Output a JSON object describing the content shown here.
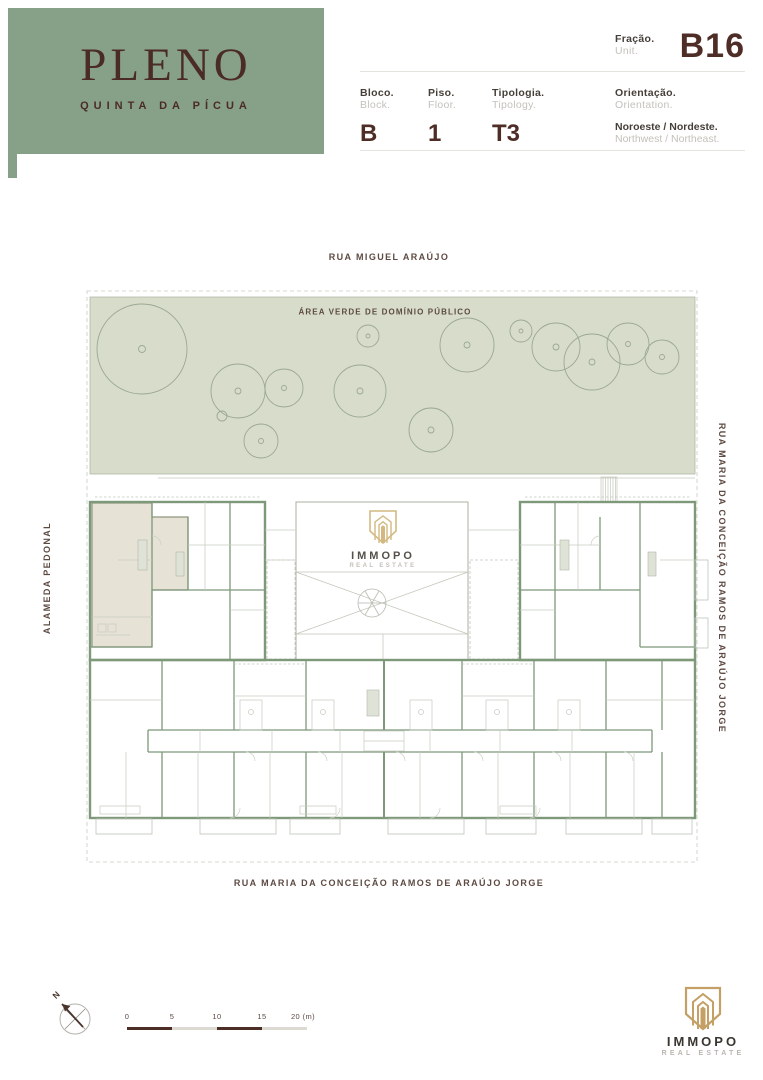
{
  "brand": {
    "name": "PLENO",
    "subtitle": "QUINTA DA PÍCUA",
    "bg_color": "#87a188",
    "text_color": "#4b2b26"
  },
  "header": {
    "fraction": {
      "label_pt": "Fração.",
      "label_en": "Unit.",
      "value": "B16"
    },
    "fields": [
      {
        "label_pt": "Bloco.",
        "label_en": "Block.",
        "value": "B"
      },
      {
        "label_pt": "Piso.",
        "label_en": "Floor.",
        "value": "1"
      },
      {
        "label_pt": "Tipologia.",
        "label_en": "Tipology.",
        "value": "T3"
      }
    ],
    "orientation": {
      "label_pt": "Orientação.",
      "label_en": "Orientation.",
      "value_pt": "Noroeste / Nordeste.",
      "value_en": "Northwest / Northeast."
    }
  },
  "plan": {
    "streets": {
      "top": "RUA MIGUEL ARAÚJO",
      "bottom": "RUA MARIA DA CONCEIÇÃO RAMOS DE ARAÚJO JORGE",
      "right": "RUA MARIA DA CONCEIÇÃO RAMOS DE ARAÚJO JORGE",
      "left": "ALAMEDA PEDONAL"
    },
    "green_area_label": "ÁREA VERDE DE DOMÍNIO PÚBLICO",
    "colors": {
      "green_area_fill": "#d8ddcb",
      "wall_green": "#7e987a",
      "unit_highlight": "#e7e2d6",
      "detail_gray": "#c7cbbf"
    }
  },
  "center_logo": {
    "name": "IMMOPO",
    "tagline": "REAL ESTATE"
  },
  "footer": {
    "compass": "N",
    "scale": {
      "ticks": [
        "0",
        "5",
        "10",
        "15",
        "20 (m)"
      ]
    },
    "logo": {
      "name": "IMMOPO",
      "tagline": "REAL ESTATE",
      "gold": "#c4a066"
    }
  }
}
